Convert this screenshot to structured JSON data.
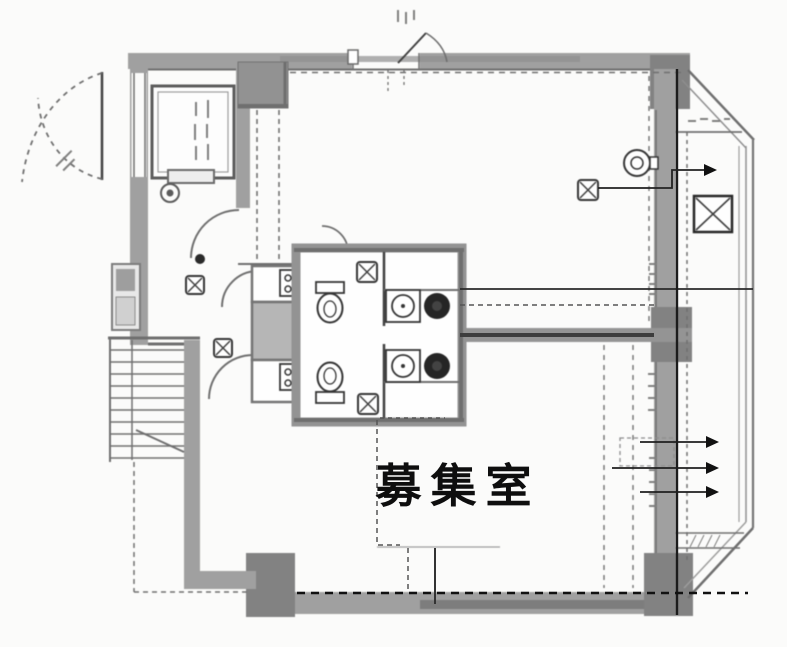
{
  "document": {
    "type": "architectural-floor-plan-scan",
    "room_label": "募集室"
  },
  "colors": {
    "paper": "#fbfbfa",
    "wall_gray": "#9d9d9d",
    "wall_dark": "#7e7e7e",
    "scan_line": "#6a6a6a",
    "ink_black": "#141414",
    "shaft_fill": "#b4b4b4"
  },
  "elements": {
    "icons": [
      "elevator-icon",
      "staircase-icon",
      "entrance-double-door-icon",
      "door-swing-icon",
      "toilet-icon",
      "washbasin-icon",
      "water-heater-icon",
      "vent-box-icon",
      "fan-icon",
      "pipe-shaft-icon",
      "meter-box-icon",
      "ac-unit-icon",
      "airflow-arrow-icon"
    ],
    "note": "all small handwritten annotations in the scan are illegible"
  }
}
